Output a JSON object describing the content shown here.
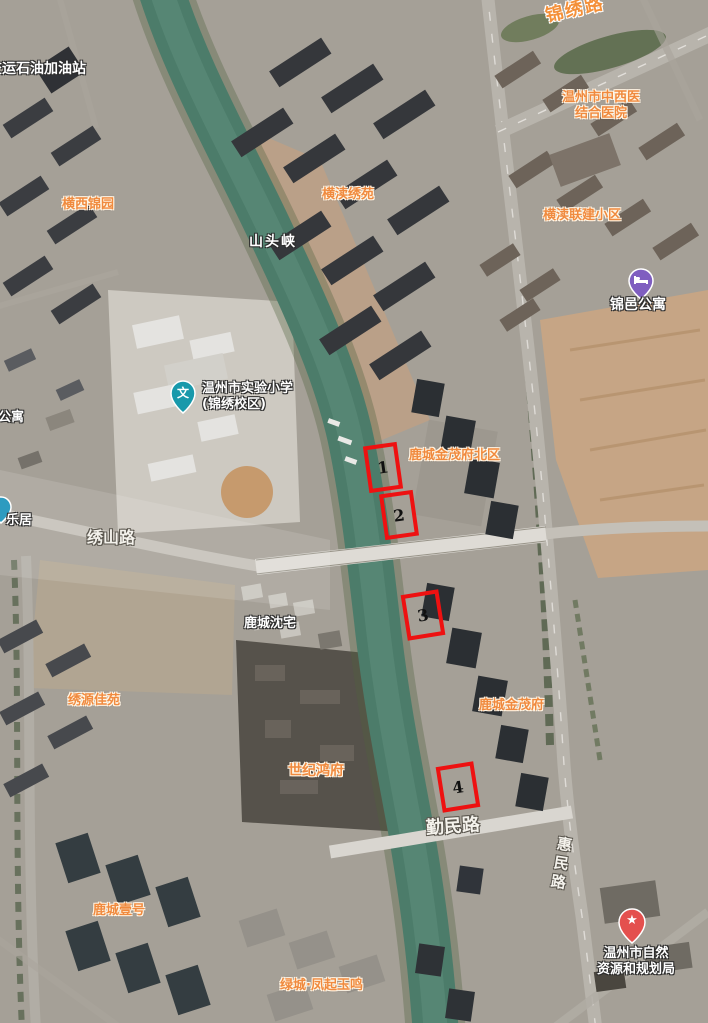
{
  "map": {
    "kind": "satellite-basemap",
    "colors": {
      "annotation_red": "#ee1111",
      "poi_orange": "#f08a3e",
      "label_white": "#ffffff",
      "river_teal": "#4c7c6a",
      "road_gray": "#b8b4ac",
      "school_pin_teal": "#1899ab",
      "apartment_pin_purple": "#7f5ec0",
      "gov_pin_red": "#e4504e"
    },
    "labels": {
      "jinxiu_road": "锦绣路",
      "gas_station": "交运石油加油站",
      "hospital_line1": "温州市中西医",
      "hospital_line2": "结合医院",
      "hengxi_jinyuan": "横西锦园",
      "hengdu_xiuyuan": "横渎绣苑",
      "hengdu_lianjian": "横渎联建小区",
      "shantouxia": "山头峡",
      "jinyi_gongyu": "锦邑公寓",
      "school_line1": "温州市实验小学",
      "school_line2": "(锦绣校区)",
      "gongyu": "公寓",
      "leju": "乐居",
      "jinmaofu_north": "鹿城金茂府北区",
      "xiushan_road": "绣山路",
      "lucheng_shenzhai": "鹿城沈宅",
      "xiuyuan_jiayuan": "绣源佳苑",
      "lucheng_jinmaofu": "鹿城金茂府",
      "shiji_hongfu": "世纪鸿府",
      "qinmin_road": "勤民路",
      "huimin_road": "惠民路",
      "gov_line1": "温州市自然",
      "gov_line2": "资源和规划局",
      "lucheng_yihao": "鹿城壹号",
      "lvcheng_fengqi": "绿城·凤起玉鸣"
    },
    "pins": {
      "school_glyph": "文",
      "gov_glyph": "★"
    },
    "markers": [
      {
        "num": "1"
      },
      {
        "num": "2"
      },
      {
        "num": "3"
      },
      {
        "num": "4"
      }
    ]
  }
}
